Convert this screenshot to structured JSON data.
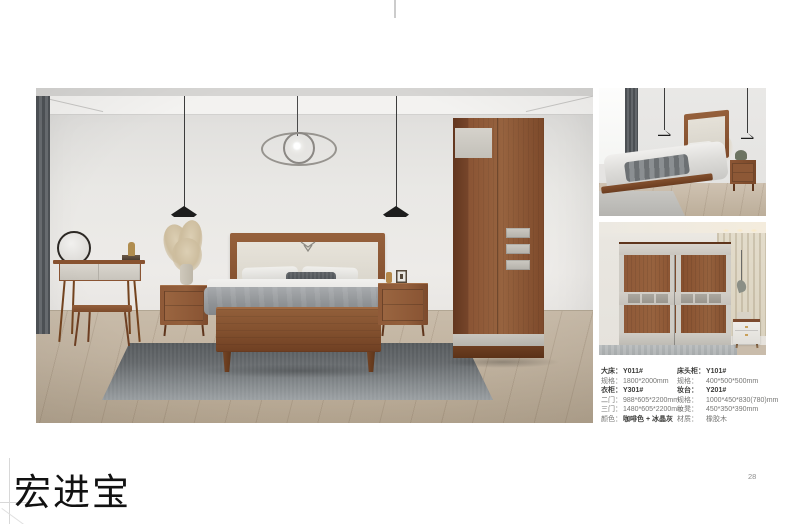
{
  "page": {
    "brand": "宏进宝",
    "page_number": "28"
  },
  "specs": {
    "left": [
      {
        "label": "大床：",
        "value": "Y011#"
      },
      {
        "label": "规格：",
        "value": "1800*2000mm"
      },
      {
        "label": "衣柜：",
        "value": "Y301#"
      },
      {
        "label": "二门：",
        "value": "988*605*2200mm"
      },
      {
        "label": "三门：",
        "value": "1480*605*2200mm"
      },
      {
        "label": "颜色：",
        "value": "咖啡色 + 冰晶灰"
      }
    ],
    "right": [
      {
        "label": "床头柜：",
        "value": "Y101#"
      },
      {
        "label": "规格：",
        "value": "400*500*500mm"
      },
      {
        "label": "妆台：",
        "value": "Y201#"
      },
      {
        "label": "规格：",
        "value": "1000*450*830(780)mm"
      },
      {
        "label": "妆凳：",
        "value": "450*350*390mm"
      },
      {
        "label": "材质：",
        "value": "橡胶木"
      }
    ]
  },
  "colors": {
    "wood": "#8a5434",
    "panel_gray": "#d6d2cb",
    "bedding_gray": "#8f9295",
    "rug_gray": "#64686b",
    "wall": "#e9e8e5",
    "text_dark": "#3c3c3a",
    "text_gray": "#767674"
  }
}
